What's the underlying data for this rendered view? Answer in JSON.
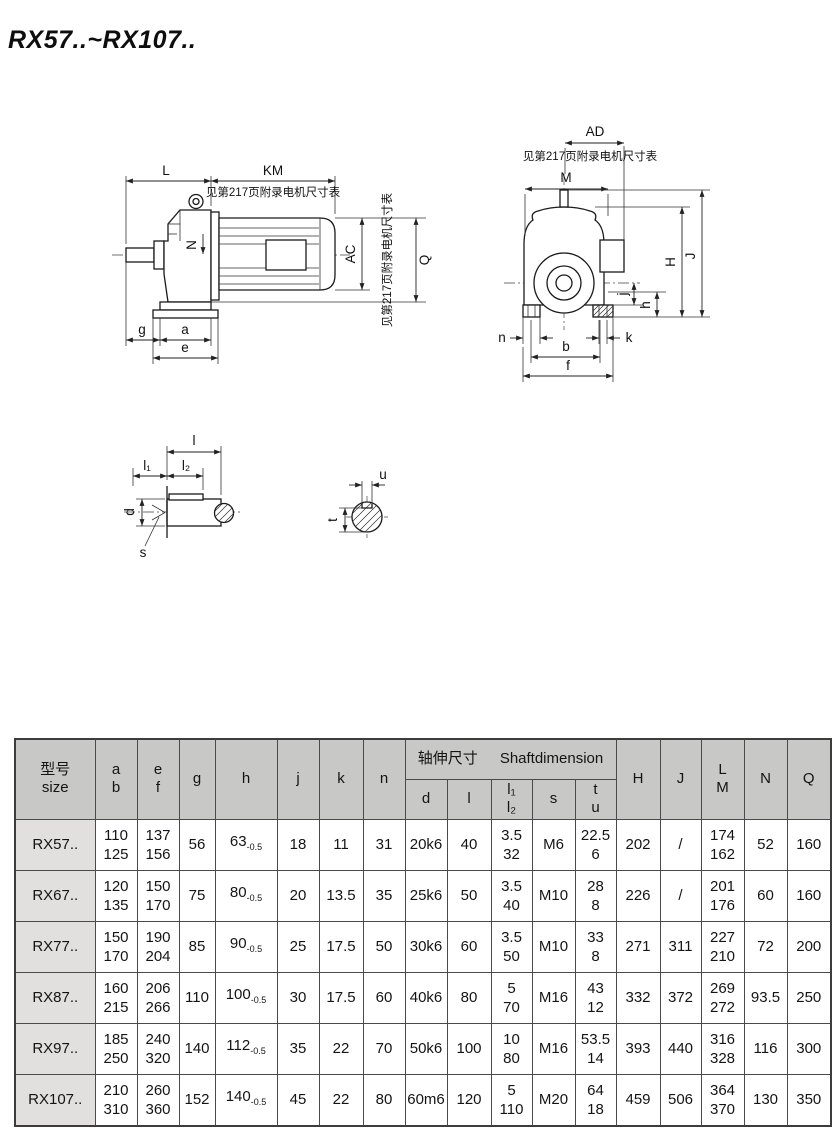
{
  "page": {
    "title": "RX57..~RX107.."
  },
  "drawings": {
    "note": "见第217页附录电机尺寸表",
    "side": {
      "L": "L",
      "KM": "KM",
      "AC": "AC",
      "Q": "Q",
      "N": "N",
      "g": "g",
      "a": "a",
      "e": "e"
    },
    "front": {
      "AD": "AD",
      "M": "M",
      "H": "H",
      "J": "J",
      "j": "j",
      "h": "h",
      "n": "n",
      "k": "k",
      "b": "b",
      "f": "f"
    },
    "shaft": {
      "l": "l",
      "l1": "l₁",
      "l2": "l₂",
      "d": "d",
      "s": "s",
      "u": "u",
      "t": "t"
    }
  },
  "table": {
    "header": {
      "model": [
        "型号",
        "size"
      ],
      "ab": [
        "a",
        "b"
      ],
      "ef": [
        "e",
        "f"
      ],
      "g": "g",
      "h": "h",
      "j": "j",
      "k": "k",
      "n": "n",
      "shaft_cn": "轴伸尺寸",
      "shaft_en": "Shaftdimension",
      "d": "d",
      "l": "l",
      "l12": [
        "l₁",
        "l₂"
      ],
      "s": "s",
      "tu": [
        "t",
        "u"
      ],
      "H": "H",
      "J": "J",
      "LM": [
        "L",
        "M"
      ],
      "N": "N",
      "Q": "Q"
    },
    "rows": [
      {
        "model": "RX57..",
        "ab": [
          "110",
          "125"
        ],
        "ef": [
          "137",
          "156"
        ],
        "g": "56",
        "h": {
          "v": "63",
          "tol": "-0.5"
        },
        "j": "18",
        "k": "11",
        "n": "31",
        "d": "20k6",
        "l": "40",
        "l12": [
          "3.5",
          "32"
        ],
        "s": "M6",
        "tu": [
          "22.5",
          "6"
        ],
        "H": "202",
        "J": "/",
        "LM": [
          "174",
          "162"
        ],
        "N": "52",
        "Q": "160"
      },
      {
        "model": "RX67..",
        "ab": [
          "120",
          "135"
        ],
        "ef": [
          "150",
          "170"
        ],
        "g": "75",
        "h": {
          "v": "80",
          "tol": "-0.5"
        },
        "j": "20",
        "k": "13.5",
        "n": "35",
        "d": "25k6",
        "l": "50",
        "l12": [
          "3.5",
          "40"
        ],
        "s": "M10",
        "tu": [
          "28",
          "8"
        ],
        "H": "226",
        "J": "/",
        "LM": [
          "201",
          "176"
        ],
        "N": "60",
        "Q": "160"
      },
      {
        "model": "RX77..",
        "ab": [
          "150",
          "170"
        ],
        "ef": [
          "190",
          "204"
        ],
        "g": "85",
        "h": {
          "v": "90",
          "tol": "-0.5"
        },
        "j": "25",
        "k": "17.5",
        "n": "50",
        "d": "30k6",
        "l": "60",
        "l12": [
          "3.5",
          "50"
        ],
        "s": "M10",
        "tu": [
          "33",
          "8"
        ],
        "H": "271",
        "J": "311",
        "LM": [
          "227",
          "210"
        ],
        "N": "72",
        "Q": "200"
      },
      {
        "model": "RX87..",
        "ab": [
          "160",
          "215"
        ],
        "ef": [
          "206",
          "266"
        ],
        "g": "110",
        "h": {
          "v": "100",
          "tol": "-0.5"
        },
        "j": "30",
        "k": "17.5",
        "n": "60",
        "d": "40k6",
        "l": "80",
        "l12": [
          "5",
          "70"
        ],
        "s": "M16",
        "tu": [
          "43",
          "12"
        ],
        "H": "332",
        "J": "372",
        "LM": [
          "269",
          "272"
        ],
        "N": "93.5",
        "Q": "250"
      },
      {
        "model": "RX97..",
        "ab": [
          "185",
          "250"
        ],
        "ef": [
          "240",
          "320"
        ],
        "g": "140",
        "h": {
          "v": "112",
          "tol": "-0.5"
        },
        "j": "35",
        "k": "22",
        "n": "70",
        "d": "50k6",
        "l": "100",
        "l12": [
          "10",
          "80"
        ],
        "s": "M16",
        "tu": [
          "53.5",
          "14"
        ],
        "H": "393",
        "J": "440",
        "LM": [
          "316",
          "328"
        ],
        "N": "116",
        "Q": "300"
      },
      {
        "model": "RX107..",
        "ab": [
          "210",
          "310"
        ],
        "ef": [
          "260",
          "360"
        ],
        "g": "152",
        "h": {
          "v": "140",
          "tol": "-0.5"
        },
        "j": "45",
        "k": "22",
        "n": "80",
        "d": "60m6",
        "l": "120",
        "l12": [
          "5",
          "110"
        ],
        "s": "M20",
        "tu": [
          "64",
          "18"
        ],
        "H": "459",
        "J": "506",
        "LM": [
          "364",
          "370"
        ],
        "N": "130",
        "Q": "350"
      }
    ]
  }
}
